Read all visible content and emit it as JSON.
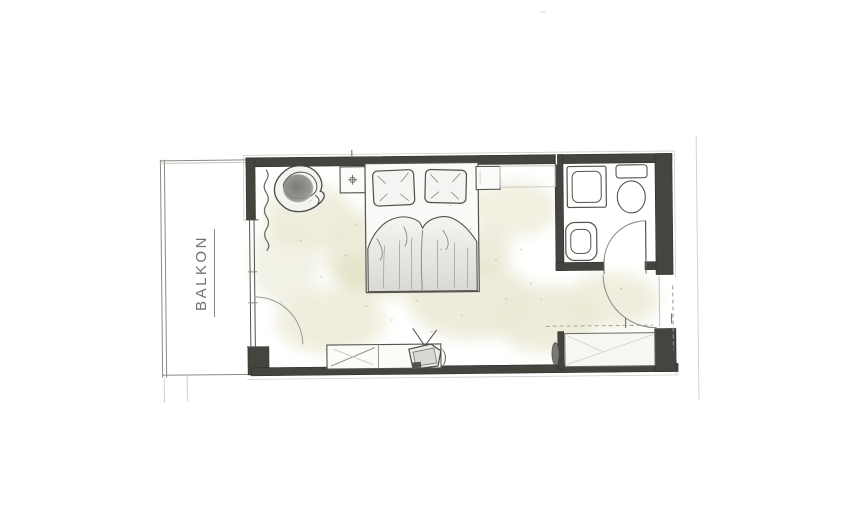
{
  "floor_plan": {
    "balcony_label": "BALKON",
    "colors": {
      "wall": "#45443f",
      "pencil_line": "#55534e",
      "light_line": "#9a9a94",
      "floor_wash": "#eae8d3",
      "floor_wash_deep": "#e2e0c4",
      "paper": "#ffffff",
      "label_text": "#73736e"
    },
    "elements": [
      "balcony",
      "balcony-railing",
      "balcony-door",
      "balcony-door-swing-arc",
      "curtain",
      "armchair",
      "nightstand-left",
      "nightstand-right",
      "double-bed",
      "pillow-left",
      "pillow-right",
      "duvet",
      "wall-console",
      "sideboard",
      "tv",
      "wardrobe-niche",
      "bathroom",
      "shower",
      "toilet",
      "sink",
      "bathroom-door",
      "entrance-door",
      "dimension-ticks",
      "property-line"
    ]
  }
}
